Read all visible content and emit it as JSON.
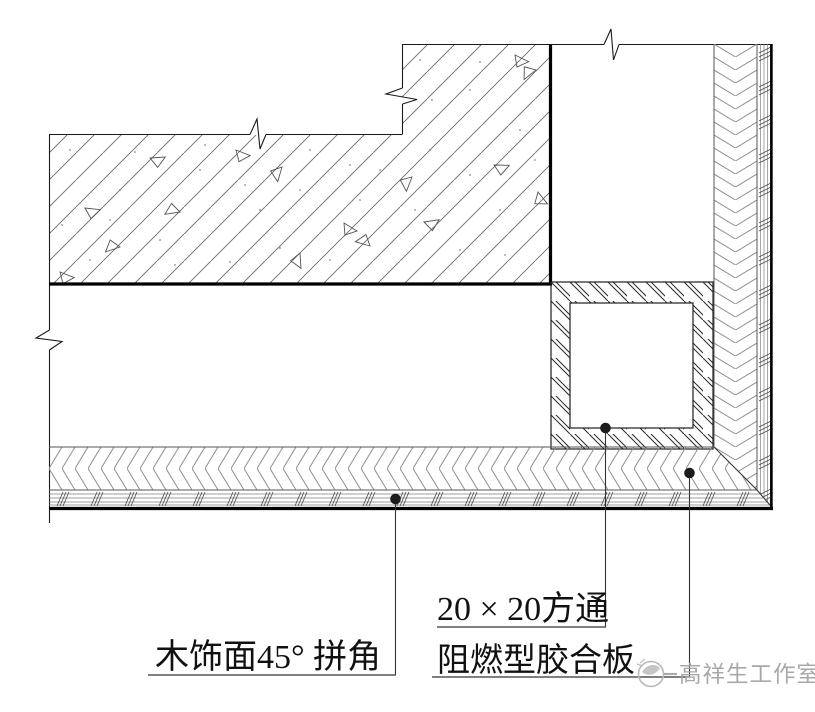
{
  "annotations": {
    "miter_label": "木饰面45° 拼角",
    "tube_label": "20 × 20方通",
    "plywood_label": "阻燃型胶合板"
  },
  "watermark": {
    "studio_name": "高祥生工作室"
  },
  "hatches": {
    "concrete": "diagonal-lines-with-aggregate-triangles",
    "plywood": "herringbone",
    "wood_veneer": "fine-lines-with-dash-groups",
    "square_tube": "steel-diagonal-pair-hatch"
  },
  "colors": {
    "line_black": "#1a1a1a",
    "hatch_gray": "#8f8f8f",
    "concrete_hatch_gray": "#666666",
    "watermark_gray": "#a8a8a8",
    "background": "#ffffff"
  }
}
